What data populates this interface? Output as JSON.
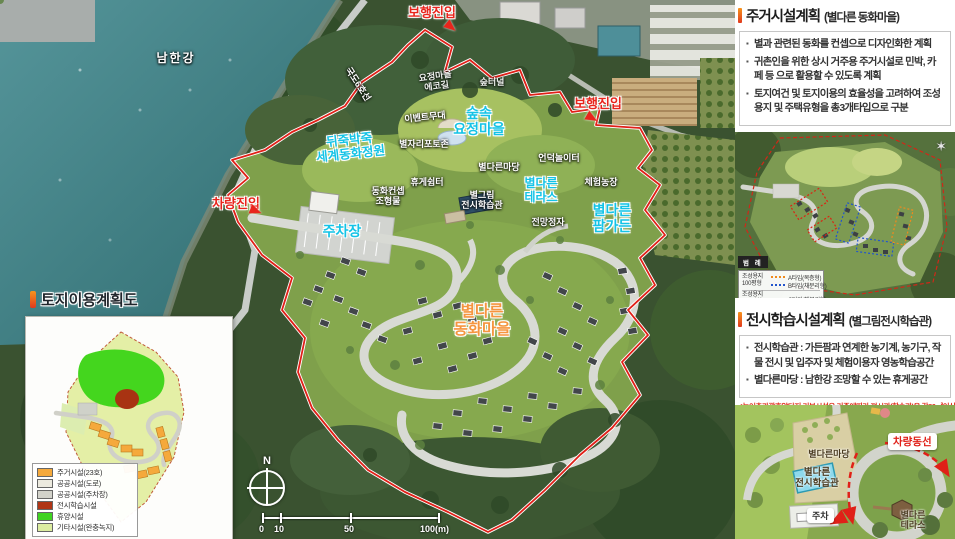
{
  "colors": {
    "accent_orange": "#f7941d",
    "accent_red": "#e03a1e",
    "label_cyan": "#14c3e6",
    "entry_red": "#e8251c",
    "village_orange": "#f5953f",
    "boundary_red": "#e02018"
  },
  "main_map": {
    "labels": {
      "river": "남한강",
      "road_name": "국도6호선",
      "pedestrian_entry_top": "보행진입",
      "pedestrian_entry_right": "보행진입",
      "vehicle_entry": "차량진입",
      "eco_trail": "요정마을\n에코길",
      "forest_tunnel": "숲터널",
      "event_stage": "이벤트무대",
      "fairy_village": "숲속\n요정마을",
      "photo_zone": "별자리포토존",
      "fairytale_garden": "뒤죽박죽\n세계동화정원",
      "parking": "주차장",
      "concept_sculpture": "동화컨셉\n조형물",
      "rest_shelter": "휴게쉼터",
      "madang": "별다른마당",
      "hill_playground": "언덕놀이터",
      "experience_farm": "체험농장",
      "exhibit_hall": "별그림\n전시학습관",
      "terrace": "별다른\n테라스",
      "pavilion": "전망정자",
      "farm_garden": "별다른\n팜가든",
      "village": "별다른\n동화마을",
      "north": "N"
    },
    "scale": {
      "t0": "0",
      "t10": "10",
      "t50": "50",
      "t100": "100(m)"
    }
  },
  "inset": {
    "title": "토지이용계획도",
    "legend": [
      {
        "label": "주거시설(23호)",
        "color": "#f5a93c"
      },
      {
        "label": "공공시설(도로)",
        "color": "#eceadf"
      },
      {
        "label": "공공시설(주차장)",
        "color": "#d2d2ca"
      },
      {
        "label": "전시학습시설",
        "color": "#b03516"
      },
      {
        "label": "휴양시설",
        "color": "#3fd321"
      },
      {
        "label": "기타시설(완충녹지)",
        "color": "#dceda0"
      }
    ]
  },
  "sidebar": {
    "housing": {
      "title": "주거시설계획",
      "subtitle": "(별다른 동화마을)",
      "bullets": [
        "별과 관련된 동화를 컨셉으로 디자인화한 계획",
        "귀촌인을 위한 상시 거주용 주거시설로 민박, 카페 등 으로 활용할 수 있도록 계획",
        "토지여건 및 토지이용의 효율성을 고려하여 조성용지 및 주택유형을 총3개타입으로 구분"
      ]
    },
    "type_map_legend": {
      "header": "범 례",
      "group1_label": "조성용지\n100평형",
      "group1_items": [
        {
          "label": "A타입(복층형)",
          "color": "#f08a1d"
        },
        {
          "label": "B타입(채분리형)",
          "color": "#2255cc"
        }
      ],
      "group2_label": "조성용지\n120평형",
      "group2_items": [
        {
          "label": "C타입(채분리형)",
          "color": "#dd2211"
        }
      ]
    },
    "exhibition": {
      "title": "전시학습시설계획",
      "subtitle": "(별그림전시학습관)",
      "bullets": [
        "전시학습관 : 가든팜과 연계한 농기계, 농기구, 작물 전시 및 입주자 및 체험이용자 영농학습공간",
        "별다른마당 : 남한강 조망할 수 있는 휴게공간"
      ],
      "note": "*농어촌관광휴양단지 기본시설은 기준에따라 전시관(학습관)을 각60㎡이상 계획"
    },
    "detail_map": {
      "labels": {
        "vehicle_flow": "차량동선",
        "madang": "별다른마당",
        "exhibit_hall": "별다른\n전시학습관",
        "parking": "주차",
        "terrace": "별다른\n테라스"
      }
    }
  }
}
